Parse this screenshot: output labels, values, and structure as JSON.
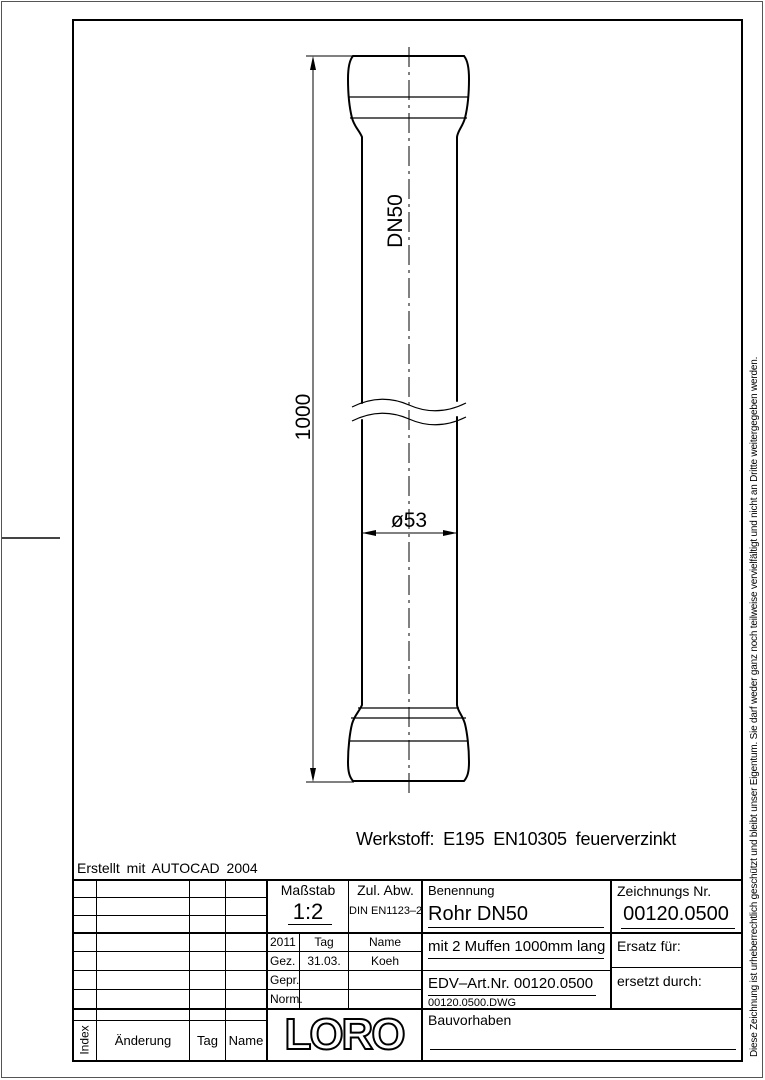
{
  "sheet": {
    "created_with": "Erstellt mit AUTOCAD 2004",
    "copyright_notice": "Diese Zeichnung ist urheberrechtlich geschützt und bleibt unser Eigentum. Sie darf weder ganz noch teilweise vervielfältigt und nicht an Dritte weitergegeben werden."
  },
  "drawing": {
    "pipe_label": "DN50",
    "dim_length": "1000",
    "dim_diameter": "ø53",
    "material_note": "Werkstoff: E195 EN10305 feuerverzinkt",
    "line_color": "#000000",
    "background_color": "#ffffff"
  },
  "title_block": {
    "massstab": {
      "label": "Maßstab",
      "value": "1:2"
    },
    "zul_abw": {
      "label": "Zul. Abw.",
      "value": "DIN EN1123–2"
    },
    "benennung": {
      "label": "Benennung",
      "value": "Rohr DN50",
      "line2": "mit 2 Muffen 1000mm lang",
      "edv_art_nr": "EDV–Art.Nr. 00120.0500",
      "file": "00120.0500.DWG"
    },
    "zeichnungs_nr": {
      "label": "Zeichnungs Nr.",
      "value": "00120.0500"
    },
    "ersatz_fuer_label": "Ersatz für:",
    "ersetzt_durch_label": "ersetzt durch:",
    "bauvorhaben_label": "Bauvorhaben",
    "approval": {
      "year": "2011",
      "col_tag": "Tag",
      "col_name": "Name",
      "rows": [
        {
          "label": "Gez.",
          "tag": "31.03.",
          "name": "Koeh"
        },
        {
          "label": "Gepr.",
          "tag": "",
          "name": ""
        },
        {
          "label": "Norm.",
          "tag": "",
          "name": ""
        }
      ]
    },
    "logo_text": "LORO",
    "revision_header": {
      "index": "Index",
      "aenderung": "Änderung",
      "tag": "Tag",
      "name": "Name"
    }
  }
}
